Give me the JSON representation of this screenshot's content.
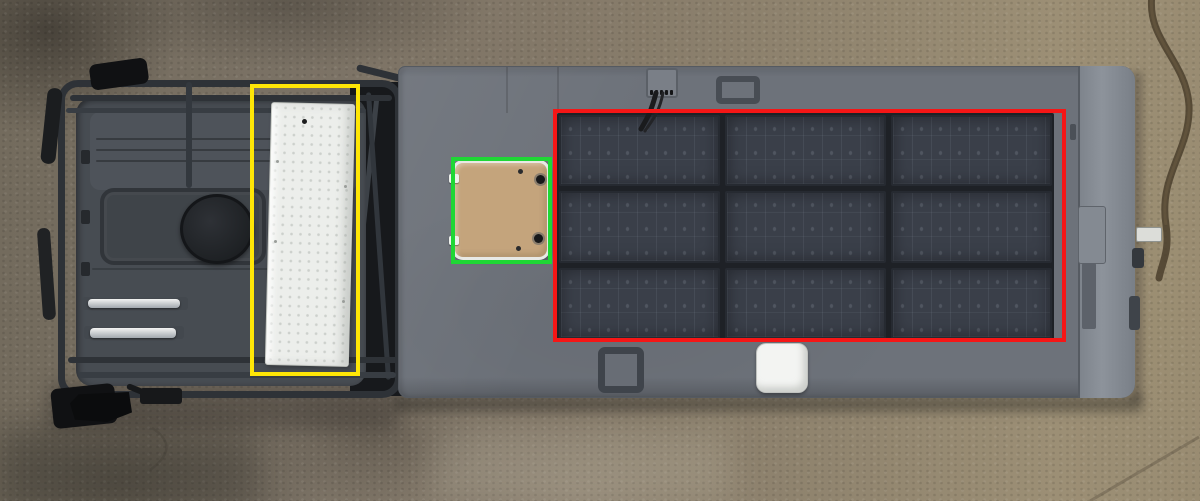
{
  "image": {
    "width": 1200,
    "height": 501
  },
  "scene": {
    "objects": {
      "ground": {
        "type": "concrete-driveway",
        "color_left": "#736b5d",
        "color_right": "#998c72"
      },
      "vehicle": {
        "type": "expedition-truck-roof-top-view",
        "cab_roof_color": "#474c52",
        "box_roof_color": "#6d727a",
        "bevel_color": "#8a9098"
      },
      "roof_rack": {
        "color": "#2e3237"
      },
      "white_storage_box": {
        "color": "#eceeeb"
      },
      "roof_hatch": {
        "color": "#c4a47c",
        "frame_color": "#e8e9e5"
      },
      "white_vent": {
        "color": "#f3f4f2"
      },
      "solar_panels": {
        "color": "#3a3f49"
      }
    }
  },
  "annotations": [
    {
      "id": "yellow-bbox",
      "subject": "white-storage-box",
      "color": "#ffe606",
      "x": 250,
      "y": 84,
      "width": 110,
      "height": 292
    },
    {
      "id": "green-bbox",
      "subject": "roof-hatch",
      "color": "#1fd735",
      "x": 451,
      "y": 157,
      "width": 101,
      "height": 107
    },
    {
      "id": "red-bbox",
      "subject": "solar-panel-array",
      "color": "#f51616",
      "x": 553,
      "y": 109,
      "width": 513,
      "height": 233
    }
  ],
  "solar_array": {
    "rows": 3,
    "cols": 3,
    "x": 557,
    "y": 113,
    "width": 497,
    "height": 228,
    "panel_color": "#3a3f49",
    "gap_color": "#1e2126"
  },
  "palette": {
    "ground_left": "#736b5d",
    "ground_right": "#998c72",
    "cab_roof": "#474c52",
    "roof": "#6d727a",
    "white_box": "#eceeeb",
    "hatch": "#c4a47c",
    "solar_panel": "#3a3f49",
    "white_vent": "#f3f4f2"
  }
}
